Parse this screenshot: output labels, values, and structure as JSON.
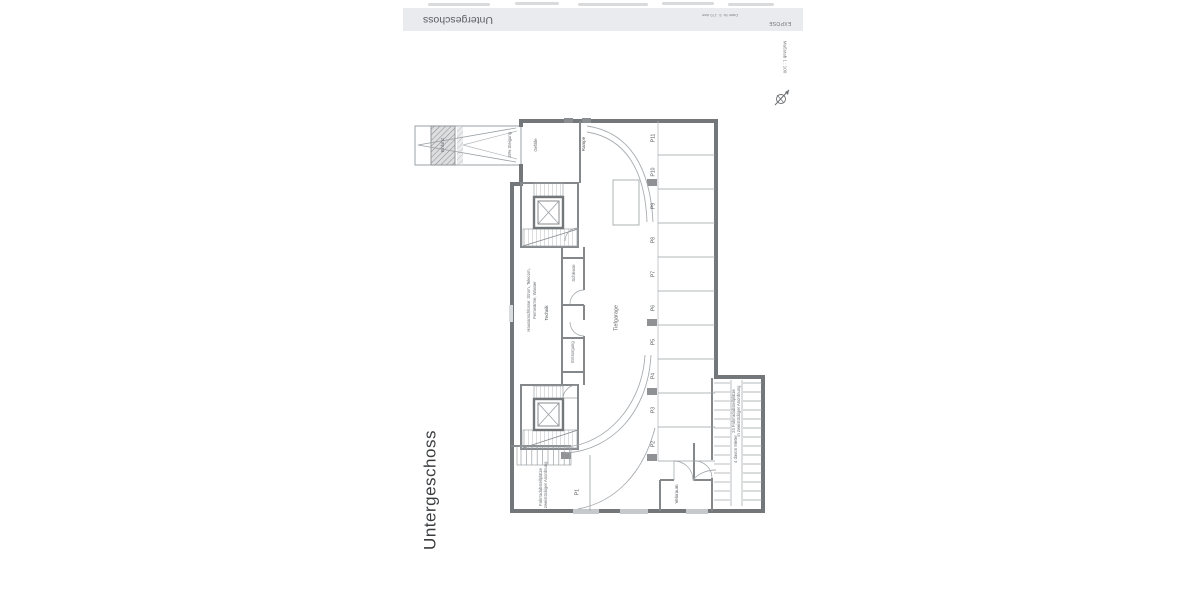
{
  "header": {
    "title": "Untergeschoss",
    "doc_ref": "Datei Nr. 5 .170 dwe",
    "stamp": "EXPOSE"
  },
  "title_vertical": "Untergeschoss",
  "scale_label": "Maßstab 1 : 100",
  "colors": {
    "header_bg": "#e9ebee",
    "wall": "#74777a",
    "partition": "#85888b",
    "thin_line": "#9aa0a4",
    "text": "#55585c",
    "column_fill": "#8f9194"
  },
  "plan": {
    "ramp": {
      "gate_label": "Einfahrt",
      "grade_label": "15% Steigung",
      "slope_label": "Gefälle",
      "name_label": "Rampe"
    },
    "garage": {
      "aisle_label": "Tiefgarage"
    },
    "parking": {
      "stall_labels": [
        "P11",
        "P10",
        "P9",
        "P8",
        "P7",
        "P6",
        "P5",
        "P4",
        "P3",
        "P2"
      ],
      "stall_p1": "P1"
    },
    "rooms": {
      "services_line1": "Hausanschlüsse: Strom, Telecom,",
      "services_line2": "Fernwärme, Wasser",
      "technik": "Technik",
      "schleuse": "Schleuse",
      "entsorgung": "Entsorgung",
      "veloraum": "Veloraum"
    },
    "bike_left": {
      "line1": "Fahrradabstellplätze",
      "line2": "in zweistöckiger Anordnung"
    },
    "bike_right": {
      "line1": "24 Fahrradabstellplätze",
      "line2": "in zweistöckiger Anordnung",
      "line3": "4 davon Mieter"
    }
  }
}
